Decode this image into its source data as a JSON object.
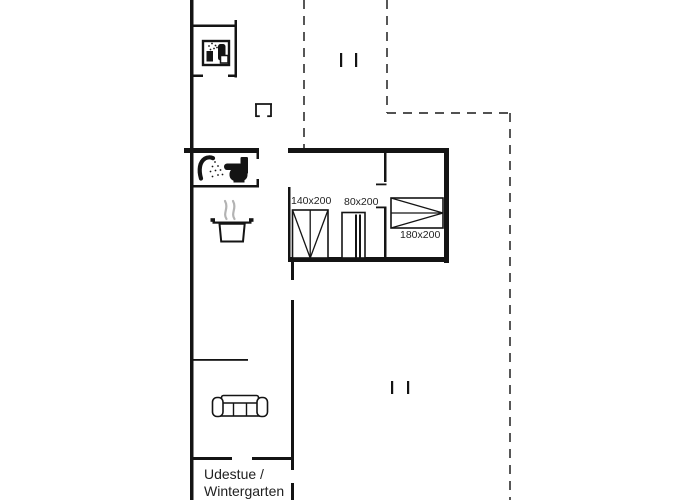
{
  "plan": {
    "room": {
      "line1": "Udestue /",
      "line2": "Wintergarten"
    },
    "beds": [
      {
        "id": "bed-140x200",
        "label": "140x200"
      },
      {
        "id": "bed-80x200",
        "label": "80x200"
      },
      {
        "id": "bed-180x200",
        "label": "180x200"
      }
    ],
    "icons": {
      "washing-machine-icon": "css-shape: bordered square with spray dots and dark appliance silhouette",
      "fireplace-icon": "css-shape: open bracket chimney symbol",
      "shower-icon": "css-shape: curved shower arm with spray dots",
      "toilet-icon": "css-shape: black toilet side silhouette",
      "cooking-pot-icon": "css-shape: pot with rim, handles and steam curls",
      "sofa-icon": "css-shape: three-seat sofa top view",
      "terrace-mark-icon": "css-shape: paired short ticks"
    },
    "colors": {
      "wall": "#141414",
      "dashed": "#3a3a3a",
      "steam": "#b3b3b3",
      "text": "#1f1f1f"
    }
  }
}
